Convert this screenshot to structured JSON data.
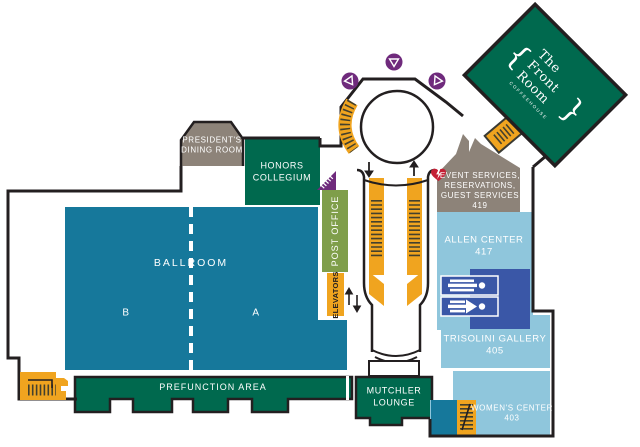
{
  "colors": {
    "teal": "#16789b",
    "green": "#00694e",
    "olive": "#7f9e4a",
    "taupe": "#8d8379",
    "light_blue": "#8fc6dc",
    "medium_blue": "#3a57a7",
    "yellow": "#f0a41f",
    "purple": "#6f2a7c",
    "red": "#c41f35",
    "outline": "#231f20",
    "white": "#ffffff"
  },
  "rooms": {
    "presidents_dining_room": {
      "label": "PRESIDENT'S\nDINING ROOM"
    },
    "honors_collegium": {
      "label": "HONORS\nCOLLEGIUM"
    },
    "post_office": {
      "label": "POST OFFICE"
    },
    "elevators": {
      "label": "ELEVATORS"
    },
    "ballroom": {
      "label": "BALLROOM",
      "section_a": "A",
      "section_b": "B"
    },
    "prefunction_area": {
      "label": "PREFUNCTION AREA"
    },
    "mutchler_lounge": {
      "label": "MUTCHLER\nLOUNGE"
    },
    "event_services": {
      "label": "EVENT SERVICES,\nRESERVATIONS,\nGUEST SERVICES\n419"
    },
    "allen_center": {
      "label": "ALLEN CENTER\n417"
    },
    "trisolini_gallery": {
      "label": "TRISOLINI GALLERY\n405"
    },
    "womens_center": {
      "label": "WOMEN'S CENTER\n403"
    },
    "front_room": {
      "name": "The Front Room",
      "subtitle": "COFFEEHOUSE",
      "brace_left": "{",
      "brace_right": "}"
    }
  },
  "glyphs": {
    "up_arrow": "↑",
    "down_arrow": "↓"
  },
  "icons": {
    "stairs": "stairs-icon (yellow hatched block)",
    "escalator": "escalator-icon (yellow hatched strip with arrow)",
    "elevator": "elevator-arrows (up/down)",
    "restroom_men": "restroom-men-icon",
    "restroom_women": "restroom-women-icon",
    "aed": "aed-heart-icon",
    "marker": "purple-circle-triangle-marker"
  }
}
